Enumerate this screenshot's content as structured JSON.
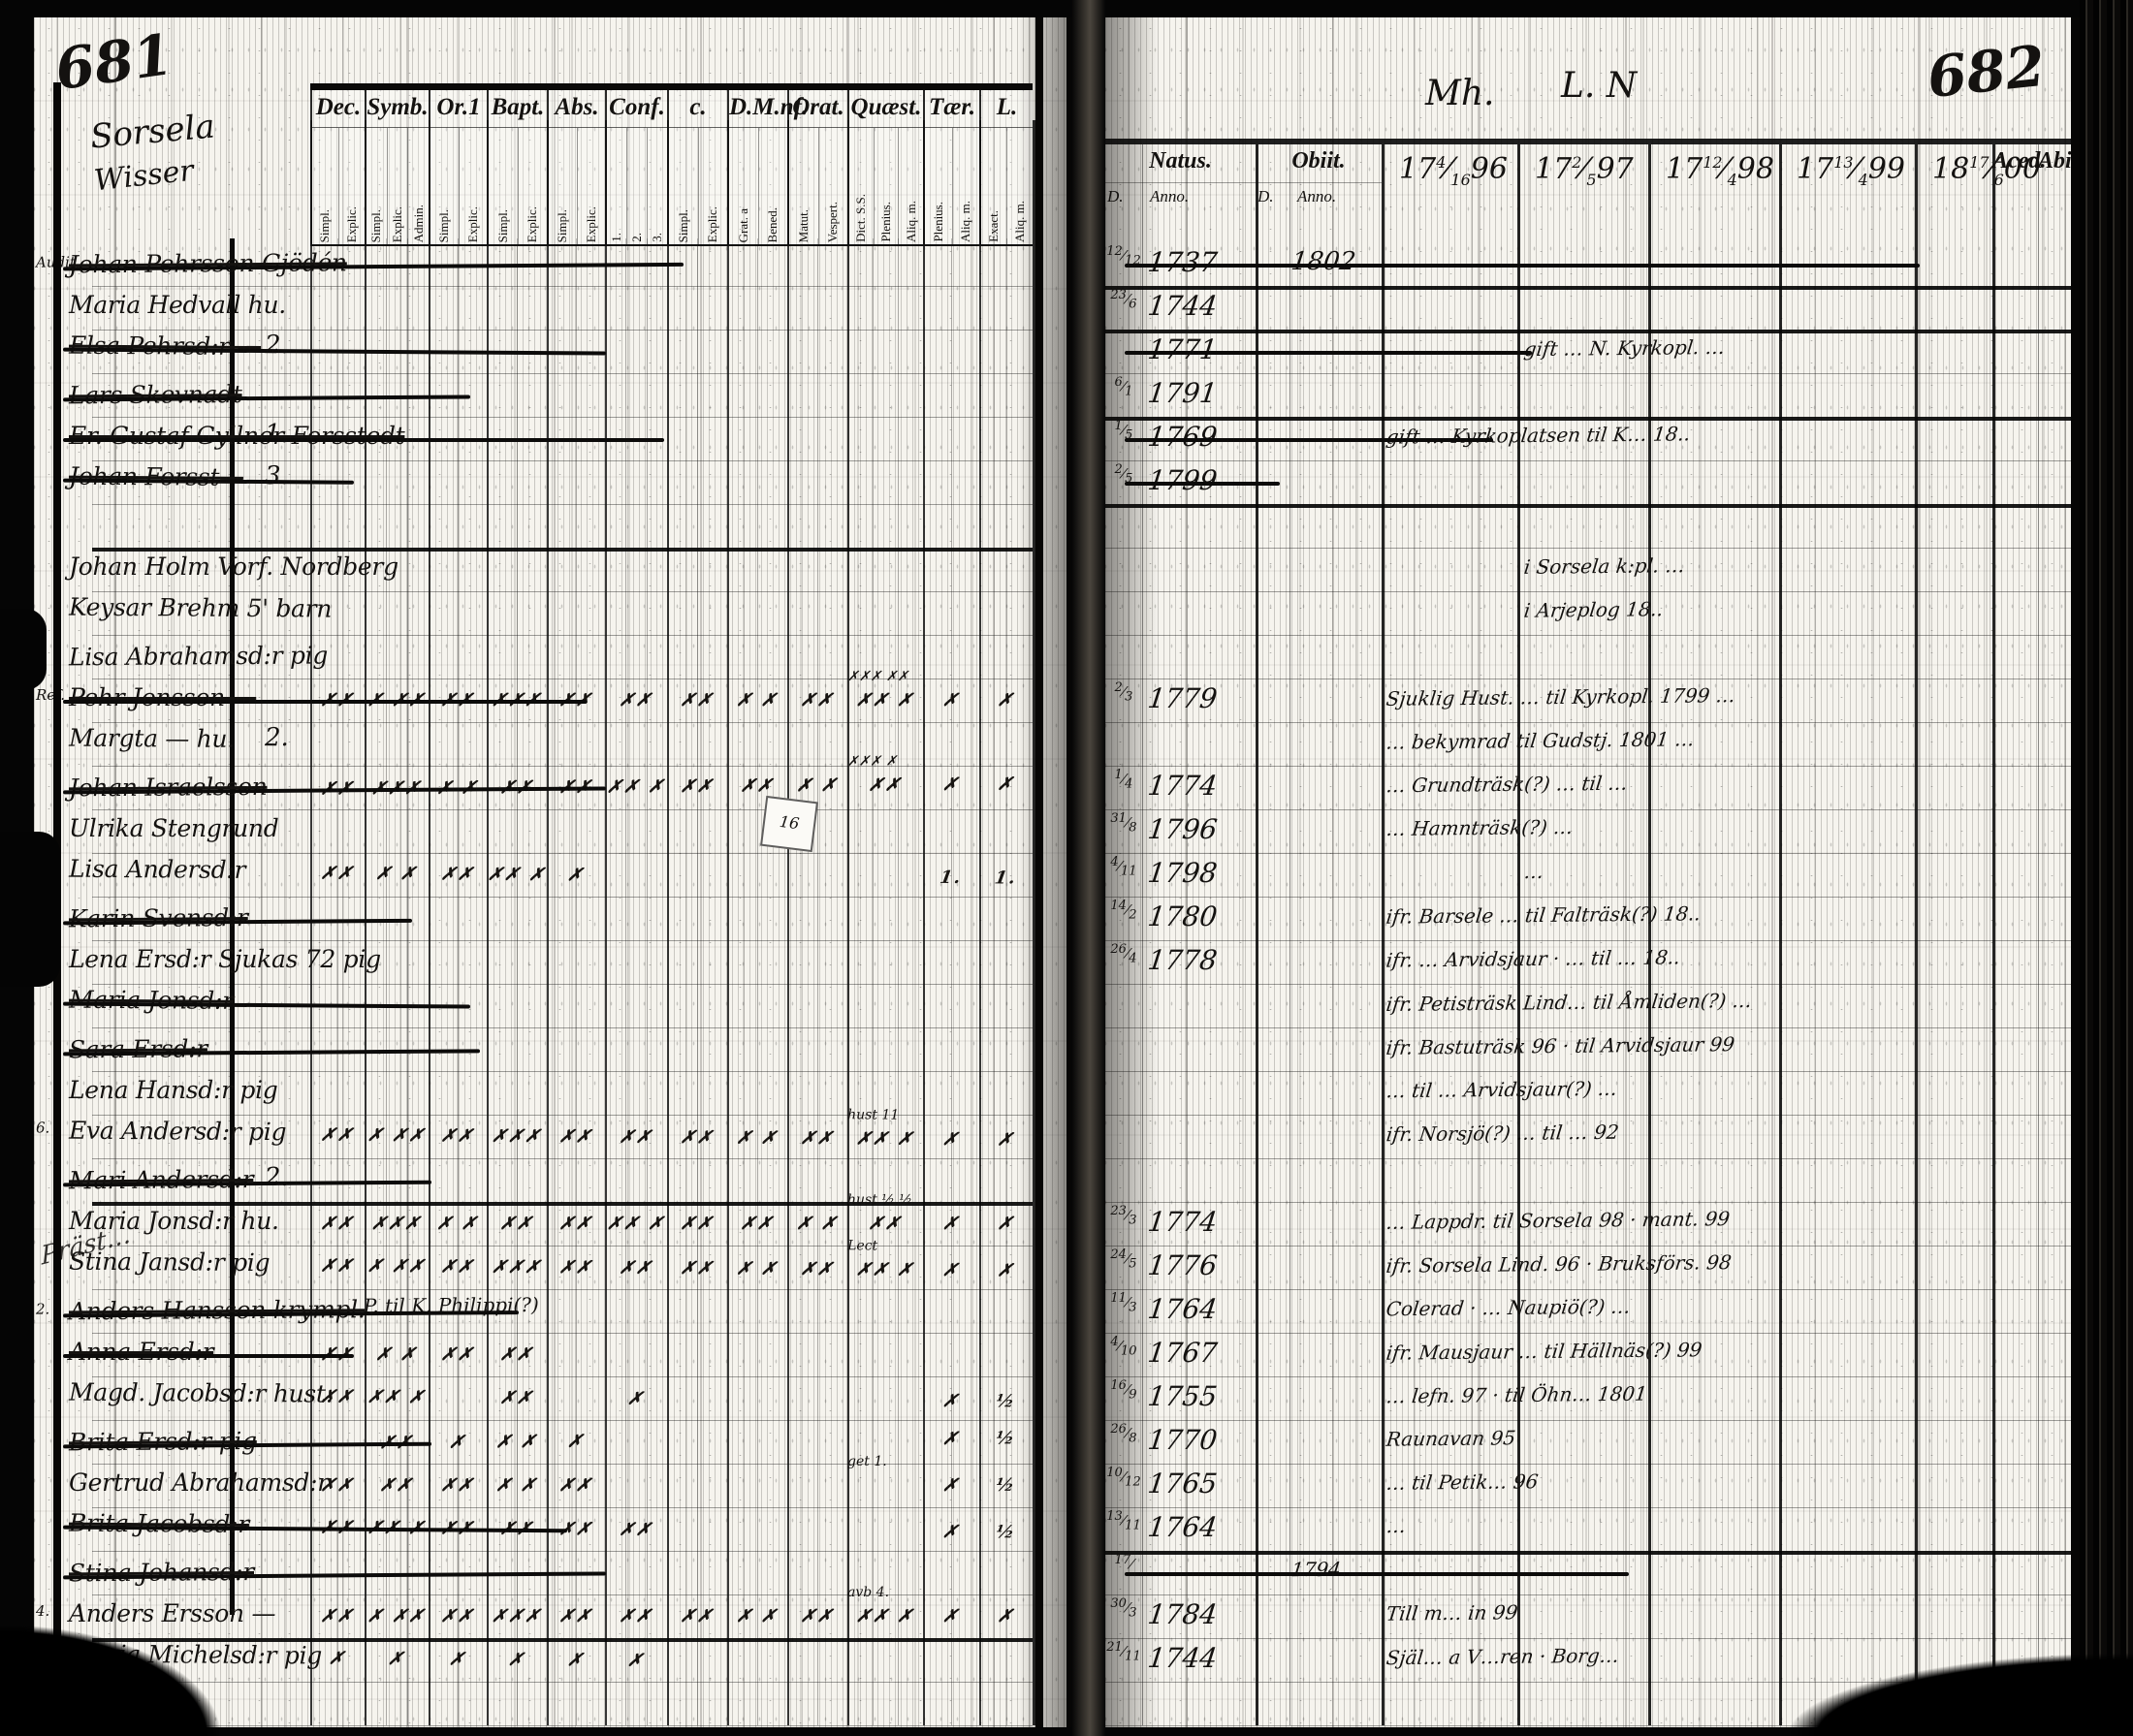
{
  "scan": {
    "left_page_no": "681",
    "right_page_no": "682",
    "parish_line1": "Sorsela",
    "parish_line2": "Wisser",
    "right_top_note_1": "Mh.",
    "right_top_note_2": "L. N",
    "margin_scrawl": "Präst…",
    "tag_text": "16"
  },
  "left_header": {
    "cols": [
      {
        "label": "Dec.",
        "subs": [
          "Simpl.",
          "Explic."
        ]
      },
      {
        "label": "Symb.",
        "subs": [
          "Simpl.",
          "Explic.",
          "Admin."
        ]
      },
      {
        "label": "Or.1",
        "subs": [
          "Simpl.",
          "Explic."
        ]
      },
      {
        "label": "Bapt.",
        "subs": [
          "Simpl.",
          "Explic."
        ]
      },
      {
        "label": "Abs.",
        "subs": [
          "Simpl.",
          "Explic."
        ]
      },
      {
        "label": "Conf.",
        "subs": [
          "1.",
          "2.",
          "3."
        ]
      },
      {
        "label": "c.",
        "subs": [
          "Simpl.",
          "Explic."
        ]
      },
      {
        "label": "D.M.nf.",
        "subs": [
          "Grat. a",
          "Bened."
        ]
      },
      {
        "label": "Orat.",
        "subs": [
          "Matut.",
          "Vespert."
        ]
      },
      {
        "label": "Quæst.",
        "subs": [
          "Dict. S.S.",
          "Plenius.",
          "Aliq. m."
        ]
      },
      {
        "label": "Tær.",
        "subs": [
          "Plenius.",
          "Aliq. m."
        ]
      },
      {
        "label": "L.",
        "subs": [
          "Exact.",
          "Aliq. m."
        ]
      }
    ]
  },
  "right_header": {
    "natus": "Natus.",
    "obiit": "Obiit.",
    "d": "D.",
    "anno": "Anno.",
    "years": [
      {
        "c": "17",
        "f": "4/16",
        "y": "96"
      },
      {
        "c": "17",
        "f": "2/5",
        "y": "97"
      },
      {
        "c": "17",
        "f": "12/4",
        "y": "98"
      },
      {
        "c": "17",
        "f": "13/4",
        "y": "99"
      },
      {
        "c": "18",
        "f": "17/6",
        "y": "00"
      }
    ],
    "aced": "Aced.",
    "abit": "Abit."
  },
  "rows": [
    {
      "mg": "Audit.",
      "nm": "Johan Pehrsson Gjödén",
      "st": true,
      "xw": 640,
      "d": "12/12",
      "a": "1737",
      "oa": "1802",
      "rxs": 820
    },
    {
      "nm": "Maria Hedvall hu.",
      "d": "23/6",
      "a": "1744"
    },
    {
      "nm": "Elsa Pehrsd:r —",
      "st": true,
      "num": "2.",
      "a": "1771",
      "note": "gift … N. Kyrkopl. …",
      "nc": "y97",
      "xw": 560,
      "rxs": 420
    },
    {
      "nm": "Lars Skevnadt",
      "st": true,
      "xw": 420,
      "d": "6/1",
      "a": "1791"
    },
    {
      "nm": "Er. Gustaf Gyllner Forsstedt",
      "st": true,
      "num": "1.",
      "xw": 620,
      "d": "1/5",
      "a": "1769",
      "note": "gift … Kyrkoplatsen til K… 18..",
      "nc": "y96",
      "rxs": 380
    },
    {
      "nm": "Johan Forsst—",
      "st": true,
      "num": "3.",
      "xw": 300,
      "d": "2/5",
      "a": "1799",
      "rxs": 160
    },
    {},
    {
      "nm": "Johan Holm Vorf. Nordberg",
      "note": "i Sorsela k:pl. …",
      "nc": "y97"
    },
    {
      "nm": "Keysar Brehm 5' barn",
      "note": "i Arjeplog 18..",
      "nc": "y97"
    },
    {
      "nm": "Lisa Abrahamsd:r pig"
    },
    {
      "mg": "Ref.",
      "nm": "Pehr Jonsson —",
      "st": true,
      "xw": 540,
      "q": "✗✗✗ ✗✗",
      "mk": [
        "✗✗",
        "✗ ✗✗",
        "✗✗",
        "✗✗✗",
        "✗✗",
        "✗✗",
        "✗✗",
        "✗ ✗",
        "✗✗",
        "✗✗ ✗",
        "✗",
        "✗"
      ],
      "d": "2/3",
      "a": "1779",
      "note": "Sjuklig Hust. … til Kyrkopl. 1799 …",
      "nc": "y96"
    },
    {
      "nm": "Margta — hu.",
      "num": "2.",
      "note": "… bekymrad til Gudstj. 1801 …",
      "nc": "y96"
    },
    {
      "nm": "Johan Israelsson",
      "st": true,
      "xw": 560,
      "q": "✗✗✗ ✗",
      "mk": [
        "✗✗",
        "✗✗✗",
        "✗ ✗",
        "✗✗",
        "✗✗",
        "✗✗ ✗",
        "✗✗",
        "✗✗",
        "✗ ✗",
        "✗✗",
        "✗",
        "✗"
      ],
      "d": "1/4",
      "a": "1774",
      "note": "… Grundträsk(?) … til …",
      "nc": "y96"
    },
    {
      "nm": "Ulrika Stengrund",
      "d": "31/8",
      "a": "1796",
      "note": "… Hamnträsk(?) …",
      "nc": "y96"
    },
    {
      "nm": "Lisa Andersd:r",
      "mk": [
        "✗✗",
        "✗ ✗",
        "✗✗",
        "✗✗ ✗",
        "✗",
        "",
        "",
        "",
        "",
        "",
        "1.",
        "1."
      ],
      "d": "4/11",
      "a": "1798",
      "note": "…",
      "nc": "y97"
    },
    {
      "nm": "Karin Svensd:r",
      "st": true,
      "xw": 360,
      "d": "14/2",
      "a": "1780",
      "note": "ifr. Barsele … til Falträsk(?) 18..",
      "nc": "y96"
    },
    {
      "nm": "Lena Ersd:r Sjukas 72 pig",
      "d": "26/4",
      "a": "1778",
      "note": "ifr. … Arvidsjaur · … til … 18..",
      "nc": "y96"
    },
    {
      "nm": "Maria Jonsd:r",
      "st": true,
      "xw": 420,
      "note": "ifr. Petisträsk Lind… til Åmliden(?) …",
      "nc": "y96"
    },
    {
      "nm": "Sara Ersd:r",
      "st": true,
      "xw": 430,
      "note": "ifr. Bastuträsk 96 · til Arvidsjaur 99",
      "nc": "y96"
    },
    {
      "nm": "Lena Hansd:r pig",
      "note": "… til … Arvidsjaur(?) …",
      "nc": "y96"
    },
    {
      "mg": "6.",
      "nm": "Eva Andersd:r pig",
      "q": "hust 11",
      "mk": [
        "✗✗",
        "✗ ✗✗",
        "✗✗",
        "✗✗✗",
        "✗✗",
        "✗✗",
        "✗✗",
        "✗ ✗",
        "✗✗",
        "✗✗ ✗",
        "✗",
        "✗"
      ],
      "note": "ifr. Norsjö(?) … til … 92",
      "nc": "y96"
    },
    {
      "nm": "Mari Andersd:r",
      "st": true,
      "num": "2.",
      "xw": 380
    },
    {
      "nm": "Maria Jonsd:r hu.",
      "q": "hust ½ ½",
      "mk": [
        "✗✗",
        "✗✗✗",
        "✗ ✗",
        "✗✗",
        "✗✗",
        "✗✗ ✗",
        "✗✗",
        "✗✗",
        "✗ ✗",
        "✗✗",
        "✗",
        "✗"
      ],
      "d": "23/3",
      "a": "1774",
      "note": "… Lappdr. til Sorsela 98 · mant. 99",
      "nc": "y96"
    },
    {
      "nm": "Stina Jansd:r pig",
      "q": "Lect",
      "mk": [
        "✗✗",
        "✗ ✗✗",
        "✗✗",
        "✗✗✗",
        "✗✗",
        "✗✗",
        "✗✗",
        "✗ ✗",
        "✗✗",
        "✗✗ ✗",
        "✗",
        "✗"
      ],
      "d": "24/5",
      "a": "1776",
      "note": "ifr. Sorsela Lind. 96 · Bruksförs. 98",
      "nc": "y96"
    },
    {
      "mg": "2.",
      "nm": "Anders Hansson krympl.",
      "st": true,
      "xw": 470,
      "gn": "P. til K. Philippi(?)",
      "d": "11/3",
      "a": "1764",
      "note": "Colerad · … Naupiö(?) …",
      "nc": "y96"
    },
    {
      "nm": "Anna Ersd:r",
      "st": true,
      "xw": 300,
      "mk": [
        "✗✗",
        "✗ ✗",
        "✗✗",
        "✗✗",
        "",
        "",
        "",
        "",
        "",
        "",
        "",
        ""
      ],
      "d": "4/10",
      "a": "1767",
      "note": "ifr. Mausjaur … til Hällnäs(?) 99",
      "nc": "y96"
    },
    {
      "nm": "Magd. Jacobsd:r hust.",
      "mk": [
        "✗✗",
        "✗✗ ✗",
        "",
        "✗✗",
        "",
        "✗",
        "",
        "",
        "",
        "",
        "✗",
        "½"
      ],
      "d": "16/9",
      "a": "1755",
      "note": "… lefn. 97 · til Öhn… 1801",
      "nc": "y96"
    },
    {
      "nm": "Brita Ersd:r pig",
      "st": true,
      "xw": 380,
      "mk": [
        "",
        "✗✗",
        "✗",
        "✗ ✗",
        "✗",
        "",
        "",
        "",
        "",
        "",
        "✗",
        "½"
      ],
      "d": "26/8",
      "a": "1770",
      "note": "Raunavan 95",
      "nc": "y96"
    },
    {
      "nm": "Gertrud Abrahamsd:r",
      "q": "get 1.",
      "mk": [
        "✗✗",
        "✗✗",
        "✗✗",
        "✗ ✗",
        "✗✗",
        "",
        "",
        "",
        "",
        "",
        "✗",
        "½"
      ],
      "d": "10/12",
      "a": "1765",
      "note": "… til Petik… 96",
      "nc": "y96"
    },
    {
      "nm": "Brita Jacobsd:r",
      "st": true,
      "xw": 520,
      "mk": [
        "✗✗",
        "✗✗ ✗",
        "✗✗",
        "✗✗",
        "✗✗",
        "✗✗",
        "",
        "",
        "",
        "",
        "✗",
        "½"
      ],
      "d": "13/11",
      "a": "1764",
      "note": "…",
      "nc": "y96"
    },
    {
      "nm": "Stina Johansd:r",
      "st": true,
      "xw": 560,
      "d": "17/",
      "note": "1794",
      "nc": "obiit",
      "rxs": 520
    },
    {
      "mg": "4.",
      "nm": "Anders Ersson —",
      "q": "avb 4.",
      "mk": [
        "✗✗",
        "✗ ✗✗",
        "✗✗",
        "✗✗✗",
        "✗✗",
        "✗✗",
        "✗✗",
        "✗ ✗",
        "✗✗",
        "✗✗ ✗",
        "✗",
        "✗"
      ],
      "d": "30/3",
      "a": "1784",
      "note": "Till m… in 99",
      "nc": "y96"
    },
    {
      "nm": "Maria Michelsd:r pig",
      "mk": [
        "✗",
        "✗",
        "✗",
        "✗",
        "✗",
        "✗",
        "",
        "",
        "",
        "",
        "",
        ""
      ],
      "d": "21/11",
      "a": "1744",
      "note": "Själ… a V…ren · Borg…",
      "nc": "y96"
    },
    {}
  ]
}
